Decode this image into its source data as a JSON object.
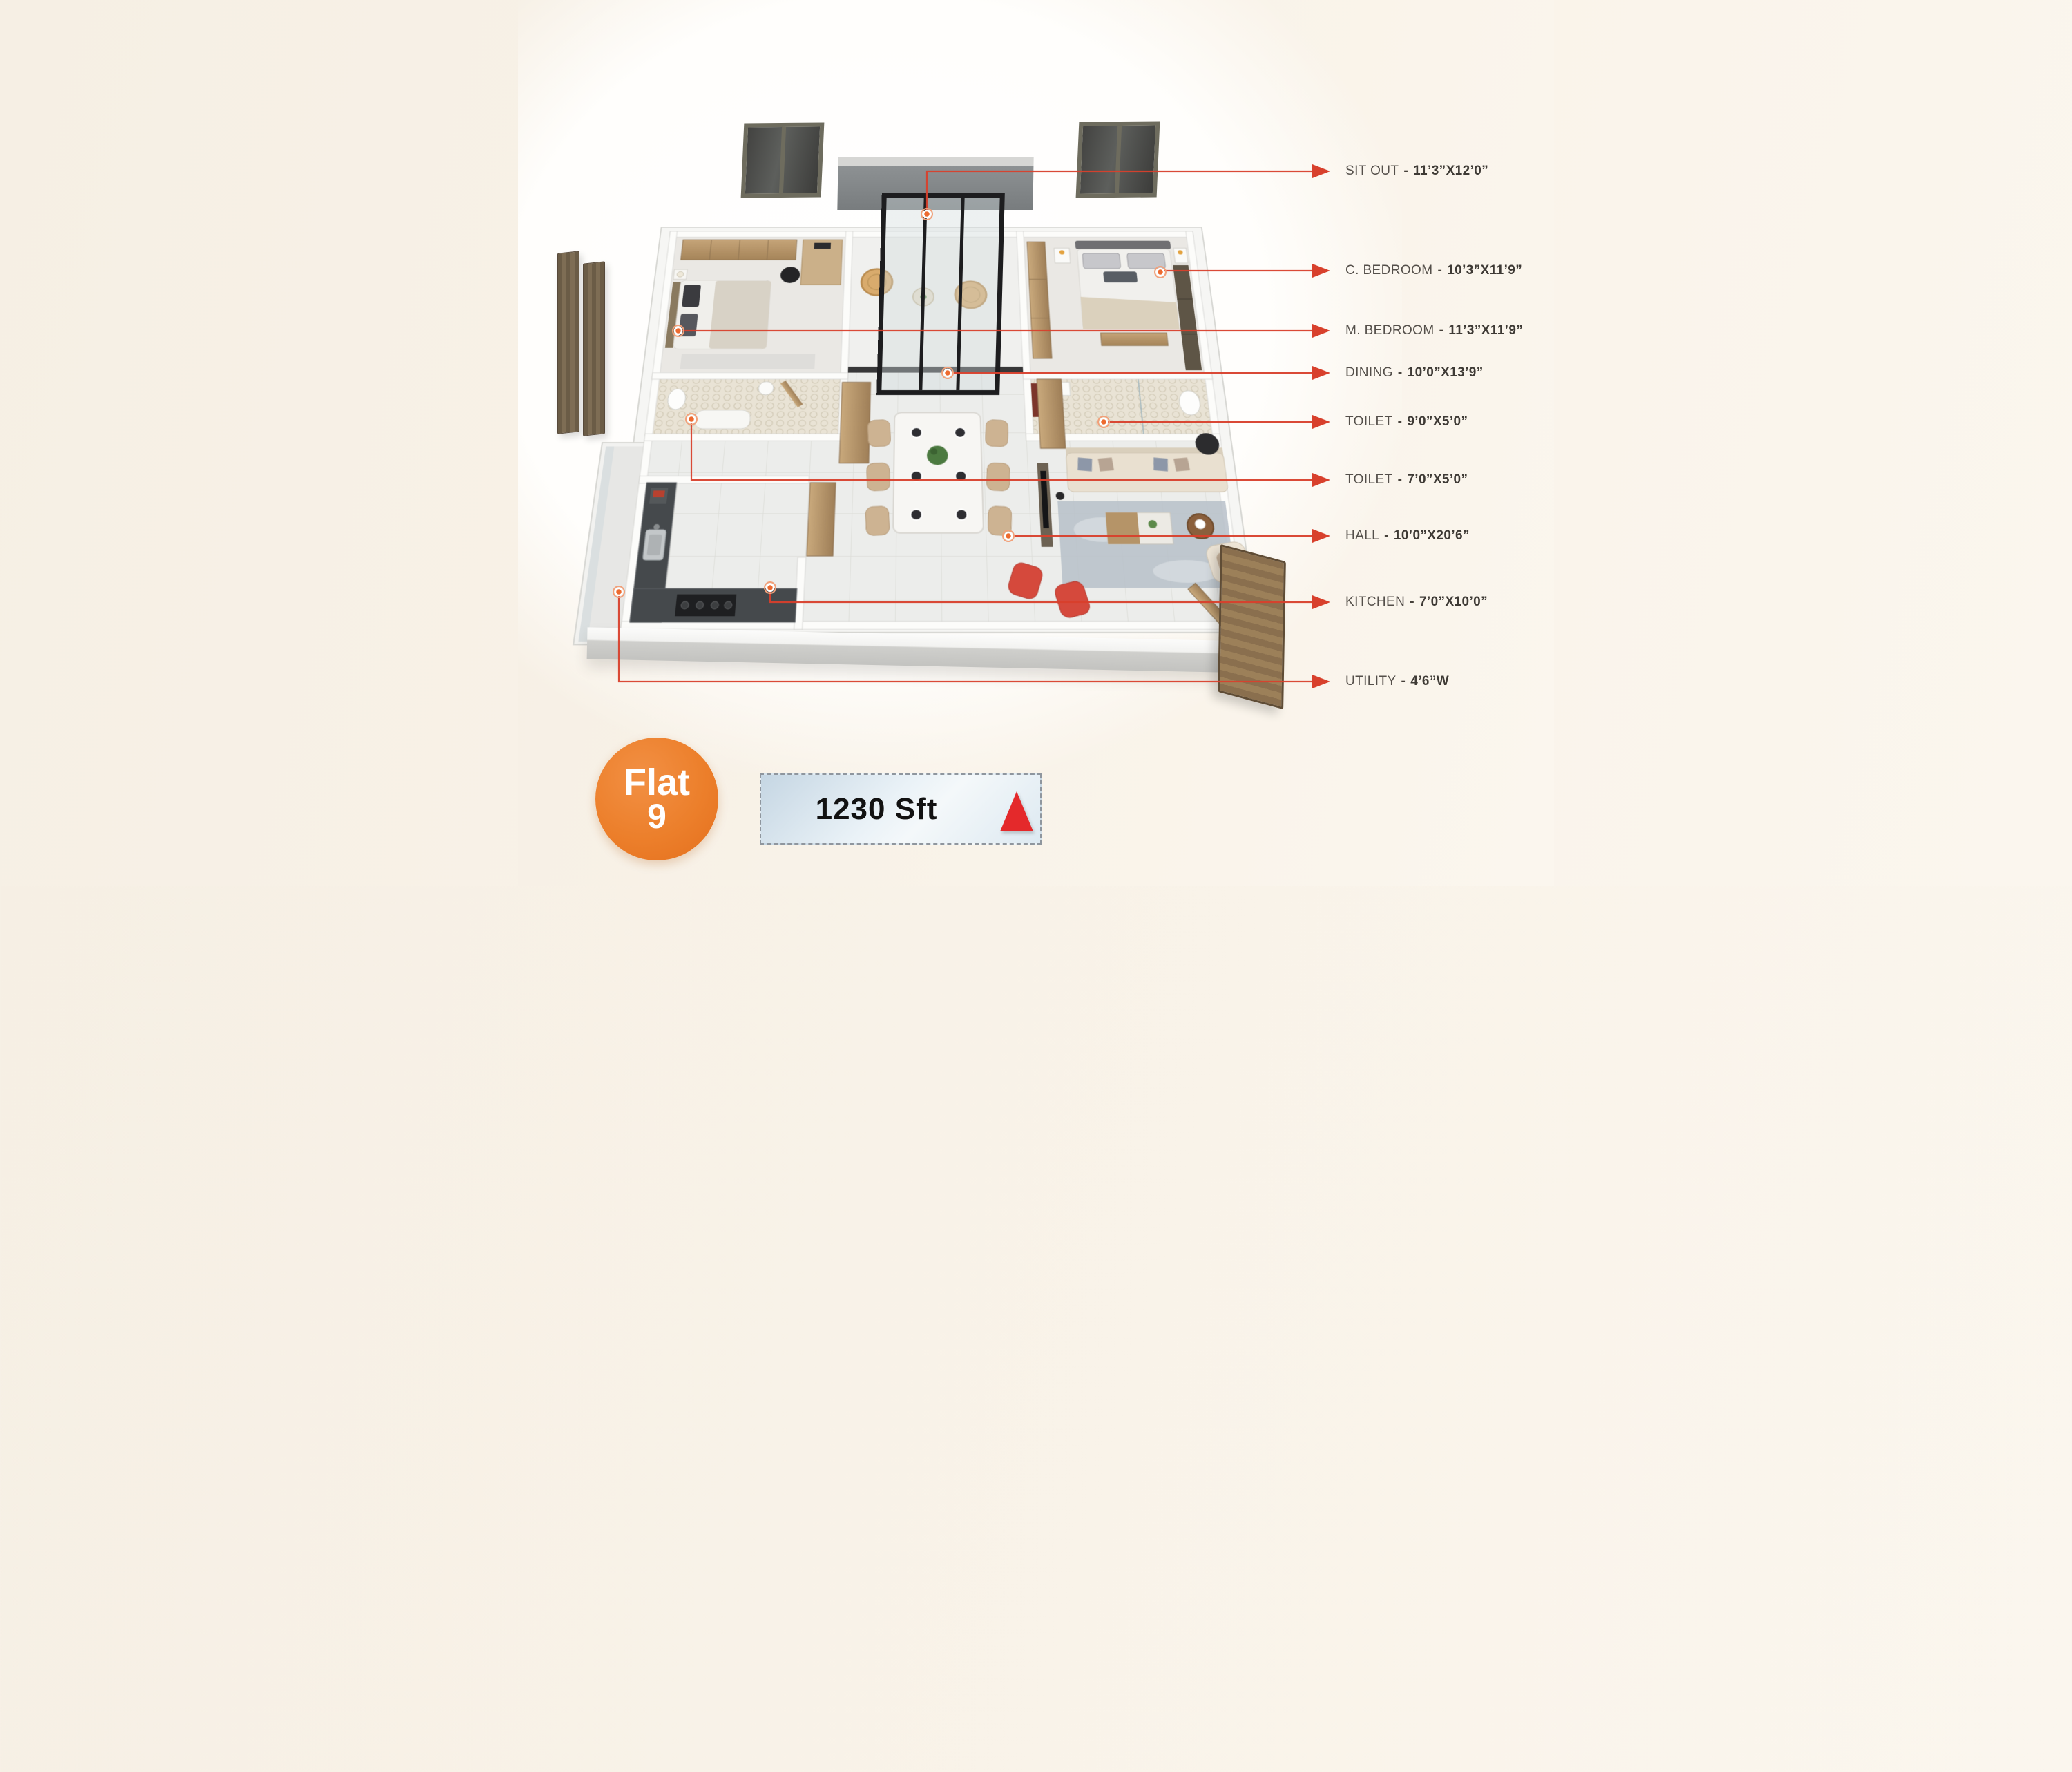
{
  "title": "Flat 9 floor plan",
  "legend": {
    "separator": "-",
    "items": [
      {
        "id": "sit-out",
        "name": "SIT OUT",
        "dims": "11’3”X12’0”"
      },
      {
        "id": "c-bedroom",
        "name": "C. BEDROOM",
        "dims": "10’3”X11’9”"
      },
      {
        "id": "m-bedroom",
        "name": "M. BEDROOM",
        "dims": "11’3”X11’9”"
      },
      {
        "id": "dining",
        "name": "DINING",
        "dims": "10’0”X13’9”"
      },
      {
        "id": "toilet-1",
        "name": "TOILET",
        "dims": "9’0”X5’0”"
      },
      {
        "id": "toilet-2",
        "name": "TOILET",
        "dims": "7’0”X5’0”"
      },
      {
        "id": "hall",
        "name": "HALL",
        "dims": "10’0”X20’6”"
      },
      {
        "id": "kitchen",
        "name": "KITCHEN",
        "dims": "7’0”X10’0”"
      },
      {
        "id": "utility",
        "name": "UTILITY",
        "dims": "4’6”W"
      }
    ]
  },
  "badge": {
    "flat_word": "Flat",
    "flat_number": "9",
    "area": "1230 Sft",
    "north_icon": "north-arrow"
  },
  "colors": {
    "leader": "#d8402c",
    "dot": "#ed6a2f",
    "badge_orange": "#ec7f2b",
    "north_red": "#e4292b",
    "background": "#f8f1e7",
    "area_box_bg": "#dce8f1"
  }
}
